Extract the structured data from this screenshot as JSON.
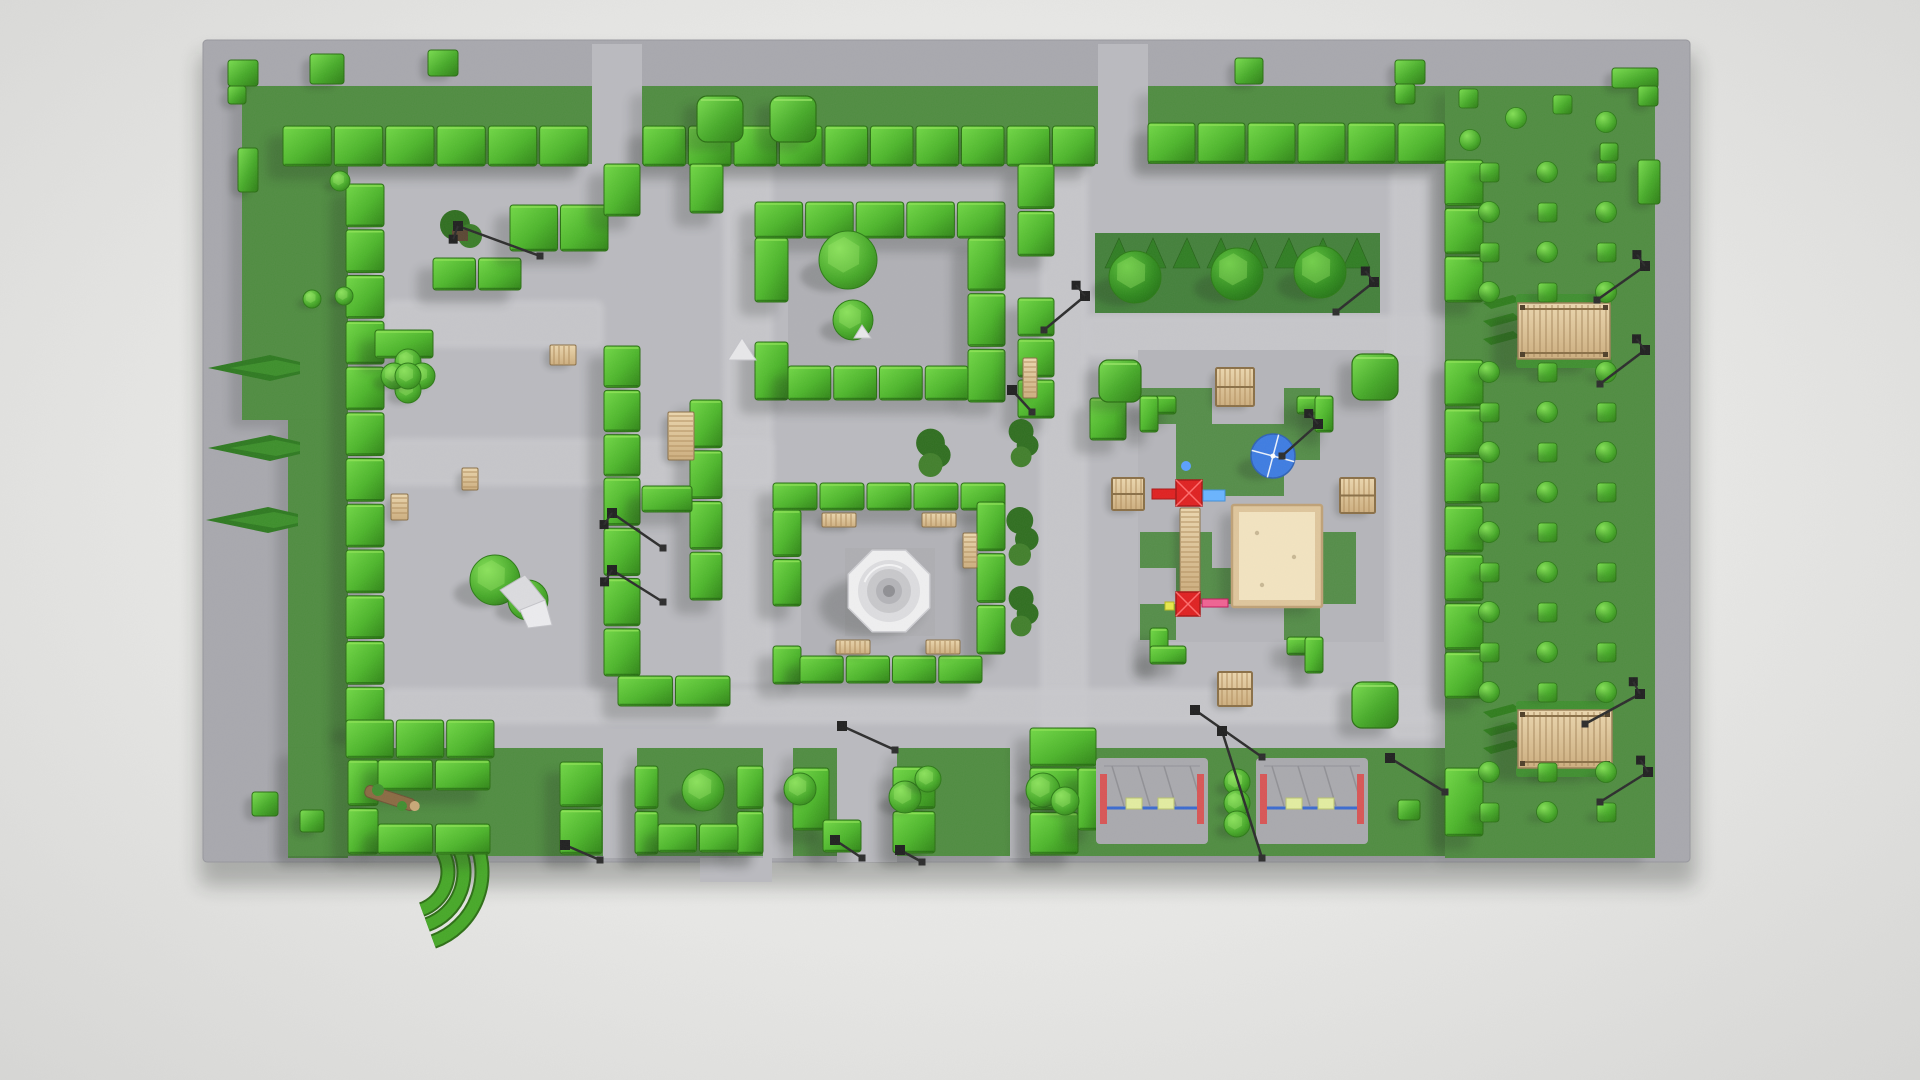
{
  "scene": {
    "meta": {
      "description": "Top-down orthographic render of a low-poly 3D park model: hedge maze, fountain plaza, playground with sandbox and swings, pergolas, lawns and topiary",
      "viewport": [
        1920,
        1080
      ]
    },
    "palette": {
      "page_bg": "#e7e7e5",
      "plate": "#a8a8ae",
      "path": "#bababf",
      "path_light": "#c9c9cd",
      "lawn": "#4f8c40",
      "lawn_dark": "#43803a",
      "checker_green": "#4c8a3e",
      "hedge_hi": "#72d946",
      "hedge_mid": "#4cb52a",
      "hedge_dark": "#2f8316",
      "hedge_edge": "#2a6e12",
      "wood_hi": "#ecd7ae",
      "wood_lo": "#cdae7e",
      "wood_edge": "#8a6f46",
      "sand": "#f3e4c0",
      "sand_frame": "#dfc69c",
      "umbrella_blue": "#3d7ce2",
      "play_red": "#e02020",
      "play_pink": "#f06292",
      "play_blue": "#69b4ff",
      "play_yellow": "#e8e84a",
      "swing_bar_blue": "#3a6ad0",
      "swing_panel_red": "#d85555",
      "swing_seat": "#e3eda0",
      "metal": "#8d8d92",
      "lamp_black": "#1f1f1f",
      "fountain_white": "#f0f0f1",
      "rock_white": "#e8e8ea"
    },
    "ground": {
      "plate": [
        203,
        40,
        1487,
        822
      ],
      "inner": [
        348,
        163,
        1097,
        585
      ],
      "tabs": [
        [
          592,
          44,
          50,
          120
        ],
        [
          1098,
          44,
          50,
          120
        ],
        [
          603,
          748,
          34,
          110
        ],
        [
          763,
          748,
          30,
          110
        ],
        [
          837,
          748,
          60,
          114
        ],
        [
          1010,
          748,
          20,
          110
        ],
        [
          700,
          858,
          72,
          24
        ]
      ]
    },
    "lawns": [
      [
        270,
        86,
        322,
        78
      ],
      [
        642,
        86,
        456,
        78
      ],
      [
        1148,
        86,
        362,
        78
      ],
      [
        242,
        86,
        106,
        334
      ],
      [
        288,
        420,
        60,
        438
      ],
      [
        288,
        748,
        315,
        108
      ],
      [
        637,
        748,
        126,
        108
      ],
      [
        793,
        748,
        44,
        108
      ],
      [
        897,
        748,
        113,
        108
      ],
      [
        1030,
        748,
        415,
        108
      ],
      [
        1445,
        86,
        210,
        772
      ]
    ],
    "beds": {
      "tree_bed": [
        1095,
        233,
        285,
        80
      ],
      "interiors": [
        [
          788,
          238,
          180,
          128,
          "#b0b0b5"
        ],
        [
          801,
          510,
          176,
          146,
          "#b2b2b7"
        ],
        [
          1138,
          350,
          246,
          292,
          "#b5b5ba"
        ]
      ],
      "checker": {
        "o": [
          1140,
          388
        ],
        "s": 36,
        "cells": [
          [
            0,
            0
          ],
          [
            1,
            0
          ],
          [
            4,
            0
          ],
          [
            1,
            1
          ],
          [
            2,
            1
          ],
          [
            3,
            1
          ],
          [
            4,
            1
          ],
          [
            1,
            2
          ],
          [
            2,
            2
          ],
          [
            3,
            2
          ],
          [
            0,
            4
          ],
          [
            1,
            4
          ],
          [
            5,
            4
          ],
          [
            1,
            5
          ],
          [
            2,
            5
          ],
          [
            5,
            5
          ],
          [
            0,
            6
          ],
          [
            4,
            6
          ]
        ]
      },
      "swing_lawn": [
        1216,
        763,
        42,
        80
      ]
    },
    "paths_light": [
      [
        384,
        300,
        220,
        48
      ],
      [
        723,
        164,
        50,
        520
      ],
      [
        384,
        438,
        390,
        48
      ],
      [
        1040,
        168,
        48,
        572
      ],
      [
        1084,
        315,
        360,
        42
      ],
      [
        1390,
        168,
        52,
        572
      ],
      [
        384,
        688,
        1052,
        36
      ]
    ],
    "walls": [
      [
        283,
        126,
        305,
        40
      ],
      [
        643,
        126,
        452,
        40
      ],
      [
        1148,
        123,
        297,
        40
      ],
      [
        1445,
        160,
        38,
        142
      ],
      [
        1445,
        360,
        38,
        338
      ],
      [
        1445,
        768,
        38,
        68
      ],
      [
        346,
        184,
        38,
        546
      ],
      [
        375,
        330,
        58,
        28
      ],
      [
        433,
        258,
        88,
        32
      ],
      [
        510,
        205,
        98,
        46
      ],
      [
        604,
        164,
        36,
        52
      ],
      [
        604,
        346,
        36,
        130
      ],
      [
        604,
        478,
        36,
        198
      ],
      [
        690,
        164,
        33,
        49
      ],
      [
        690,
        400,
        32,
        200
      ],
      [
        642,
        486,
        50,
        26
      ],
      [
        618,
        676,
        112,
        30
      ],
      [
        346,
        720,
        148,
        38
      ],
      [
        755,
        202,
        250,
        36
      ],
      [
        755,
        238,
        33,
        64
      ],
      [
        755,
        342,
        33,
        58
      ],
      [
        968,
        238,
        37,
        164
      ],
      [
        788,
        366,
        180,
        34
      ],
      [
        773,
        483,
        232,
        27
      ],
      [
        773,
        510,
        28,
        96
      ],
      [
        773,
        646,
        28,
        38
      ],
      [
        977,
        502,
        28,
        152
      ],
      [
        800,
        656,
        182,
        27
      ],
      [
        1018,
        164,
        36,
        92
      ],
      [
        1018,
        298,
        36,
        120
      ],
      [
        1090,
        398,
        36,
        42
      ],
      [
        348,
        760,
        30,
        94
      ],
      [
        378,
        760,
        112,
        30
      ],
      [
        378,
        824,
        112,
        30
      ],
      [
        560,
        762,
        42,
        92
      ],
      [
        635,
        766,
        23,
        88
      ],
      [
        737,
        766,
        26,
        88
      ],
      [
        658,
        824,
        80,
        28
      ],
      [
        793,
        768,
        36,
        62
      ],
      [
        823,
        820,
        38,
        32
      ],
      [
        893,
        767,
        42,
        86
      ],
      [
        1030,
        728,
        66,
        38
      ],
      [
        1030,
        768,
        48,
        86
      ],
      [
        1078,
        768,
        20,
        62
      ],
      [
        1140,
        396,
        36,
        18
      ],
      [
        1140,
        396,
        18,
        36
      ],
      [
        1297,
        396,
        36,
        18
      ],
      [
        1315,
        396,
        18,
        36
      ],
      [
        1150,
        628,
        18,
        36
      ],
      [
        1150,
        646,
        36,
        18
      ],
      [
        1287,
        637,
        36,
        18
      ],
      [
        1305,
        637,
        18,
        36
      ]
    ],
    "cubes_small": [
      [
        228,
        60,
        30,
        26
      ],
      [
        228,
        86,
        18,
        18
      ],
      [
        310,
        54,
        34,
        30
      ],
      [
        428,
        50,
        30,
        26
      ],
      [
        238,
        148,
        20,
        44
      ],
      [
        1235,
        58,
        28,
        26
      ],
      [
        1395,
        60,
        30,
        24
      ],
      [
        1395,
        84,
        20,
        20
      ],
      [
        1612,
        68,
        46,
        20
      ],
      [
        1638,
        86,
        20,
        20
      ],
      [
        1600,
        143,
        18,
        18
      ],
      [
        1638,
        160,
        22,
        44
      ],
      [
        252,
        792,
        26,
        24
      ],
      [
        300,
        810,
        24,
        22
      ],
      [
        1398,
        800,
        22,
        20
      ]
    ],
    "cubes_big": [
      [
        697,
        96,
        46
      ],
      [
        770,
        96,
        46
      ],
      [
        1099,
        360,
        42
      ],
      [
        1352,
        354,
        46
      ],
      [
        1352,
        682,
        46
      ]
    ],
    "bushes_round": [
      [
        340,
        181,
        10
      ],
      [
        312,
        299,
        9
      ],
      [
        344,
        296,
        9
      ]
    ],
    "spheres": [
      [
        848,
        260,
        29
      ],
      [
        853,
        320,
        20
      ],
      [
        703,
        790,
        21
      ],
      [
        800,
        789,
        16
      ],
      [
        905,
        797,
        16
      ],
      [
        928,
        779,
        13
      ],
      [
        1043,
        790,
        17
      ],
      [
        1065,
        801,
        14
      ],
      [
        495,
        580,
        25
      ],
      [
        528,
        600,
        20
      ]
    ],
    "flower_topiary": [
      408,
      376
    ],
    "trees": [
      [
        1135,
        277,
        26
      ],
      [
        1237,
        274,
        26
      ],
      [
        1320,
        272,
        26
      ]
    ],
    "firs": [
      [
        300,
        368
      ],
      [
        300,
        448
      ],
      [
        298,
        520
      ]
    ],
    "sawtooth": {
      "x": 1105,
      "y": 268,
      "n": 8,
      "step": 34,
      "h": 30
    },
    "slashes": [
      [
        1483,
        303
      ],
      [
        1483,
        321
      ],
      [
        1483,
        339
      ],
      [
        1483,
        712
      ],
      [
        1483,
        730
      ],
      [
        1483,
        748
      ]
    ],
    "benches": [
      [
        822,
        513,
        34,
        14
      ],
      [
        922,
        513,
        34,
        14
      ],
      [
        963,
        533,
        14,
        35
      ],
      [
        836,
        640,
        34,
        14
      ],
      [
        926,
        640,
        34,
        14
      ],
      [
        668,
        412,
        26,
        48
      ],
      [
        550,
        345,
        26,
        20
      ],
      [
        391,
        494,
        17,
        26
      ],
      [
        462,
        468,
        16,
        22
      ],
      [
        1023,
        358,
        14,
        40
      ]
    ],
    "tables": [
      [
        1216,
        368,
        38
      ],
      [
        1340,
        478,
        35
      ],
      [
        1218,
        672,
        34
      ],
      [
        1112,
        478,
        32
      ]
    ],
    "fountain": {
      "c": [
        889,
        591
      ],
      "pad": [
        845,
        548,
        90,
        88
      ]
    },
    "sandbox": [
      1232,
      505,
      90,
      102
    ],
    "umbrella": [
      1273,
      456,
      22
    ],
    "playset": {
      "top": [
        1176,
        480
      ],
      "bottom": [
        1176,
        592
      ],
      "ladder": [
        1180,
        508,
        20,
        86
      ]
    },
    "swings": [
      [
        1096,
        758
      ],
      [
        1256,
        758
      ]
    ],
    "swing_spheres": [
      [
        1237,
        782,
        13
      ],
      [
        1237,
        803,
        13
      ],
      [
        1237,
        824,
        13
      ]
    ],
    "pergolas": [
      [
        1518,
        303,
        92,
        56
      ],
      [
        1518,
        710,
        94,
        58
      ]
    ],
    "bush_grid": {
      "cols": [
        1489,
        1547,
        1606
      ],
      "y0": 172,
      "y1": 816,
      "step": 40,
      "skip": [
        [
          295,
          365
        ],
        [
          695,
          772
        ]
      ]
    },
    "bush_scatter": [
      [
        1468,
        98,
        "sq"
      ],
      [
        1516,
        118,
        "rd"
      ],
      [
        1470,
        140,
        "rd"
      ],
      [
        1562,
        104,
        "sq"
      ],
      [
        1606,
        122,
        "rd"
      ]
    ],
    "flower_beds": [
      [
        1012,
        420,
        26,
        46
      ],
      [
        1010,
        505,
        28,
        62
      ],
      [
        1012,
        586,
        26,
        50
      ],
      [
        920,
        433,
        30,
        40
      ]
    ],
    "rose_planter": [
      455,
      222
    ],
    "rocks": {
      "formation": [
        512,
        598
      ],
      "tent": [
        742,
        350
      ],
      "small": [
        862,
        332
      ]
    },
    "log": [
      390,
      798
    ],
    "arcs": {
      "c": [
        408,
        872
      ],
      "radii": [
        74,
        56,
        40
      ],
      "a0": 150,
      "a1": 250
    },
    "lamps": [
      [
        458,
        226,
        540,
        256,
        1
      ],
      [
        612,
        513,
        663,
        548,
        1
      ],
      [
        612,
        570,
        663,
        602,
        1
      ],
      [
        565,
        845,
        600,
        860,
        0
      ],
      [
        835,
        840,
        862,
        858,
        0
      ],
      [
        842,
        726,
        895,
        750,
        0
      ],
      [
        1012,
        390,
        1032,
        412,
        0
      ],
      [
        1085,
        296,
        1044,
        330,
        1
      ],
      [
        1374,
        282,
        1336,
        312,
        1
      ],
      [
        1318,
        424,
        1282,
        456,
        1
      ],
      [
        1195,
        710,
        1262,
        757,
        0
      ],
      [
        1222,
        731,
        1262,
        858,
        0
      ],
      [
        1390,
        758,
        1445,
        792,
        0
      ],
      [
        1645,
        266,
        1597,
        300,
        1
      ],
      [
        1645,
        350,
        1600,
        384,
        1
      ],
      [
        1640,
        694,
        1585,
        724,
        1
      ],
      [
        1648,
        772,
        1600,
        802,
        1
      ],
      [
        900,
        850,
        922,
        862,
        0
      ]
    ]
  }
}
